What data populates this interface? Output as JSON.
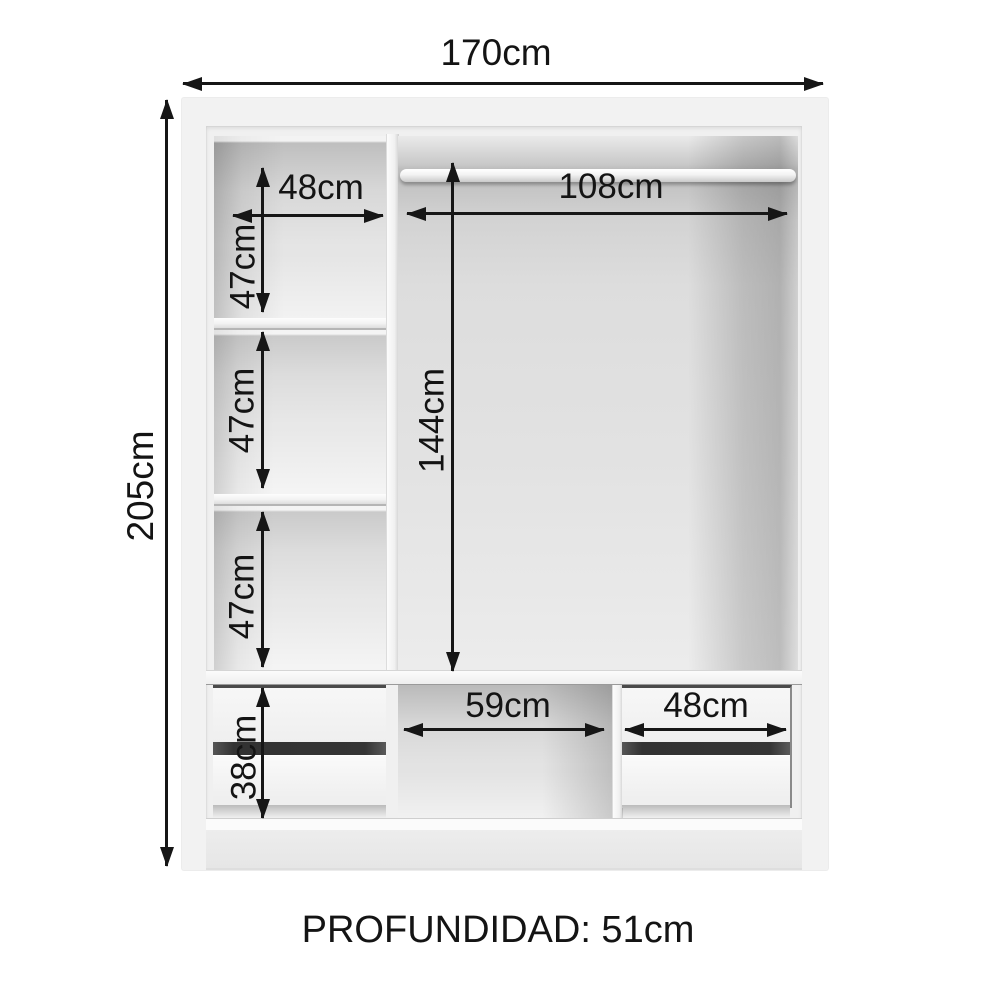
{
  "diagram": {
    "type": "wardrobe-internal-dimensions",
    "dims": {
      "total_width": "170cm",
      "total_height": "205cm",
      "left_shelf_width": "48cm",
      "hanging_width": "108cm",
      "upper_shelf_height": "47cm",
      "middle_shelf_height": "47cm",
      "lower_shelf_height": "47cm",
      "hanging_height": "144cm",
      "drawer_height": "38cm",
      "center_niche_width": "59cm",
      "right_drawer_width": "48cm"
    },
    "footer": {
      "depth": "PROFUNDIDAD: 51cm"
    },
    "colors": {
      "line": "#161616",
      "text": "#141414",
      "cabinet_frame": "#f2f2f2",
      "background": "#ffffff",
      "drawer_gap": "#353535"
    }
  }
}
